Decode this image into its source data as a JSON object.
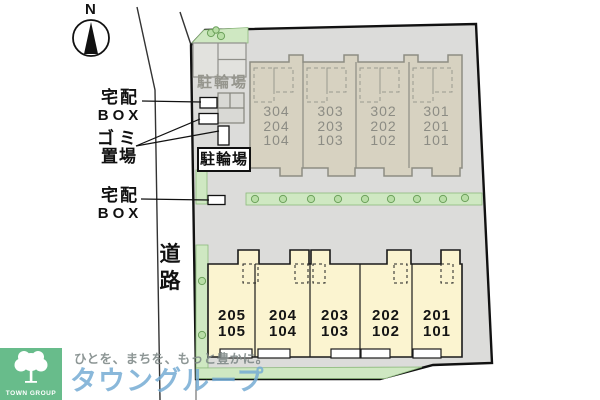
{
  "plan": {
    "compass": "N",
    "road_label": [
      "道",
      "路"
    ],
    "labels": {
      "delivery_box_top": [
        "宅配",
        "BOX"
      ],
      "garbage_area": [
        "ゴミ",
        "置場"
      ],
      "delivery_box_bottom": [
        "宅配",
        "BOX"
      ],
      "bicycle_parking_area": "駐輪場",
      "bicycle_parking_sign": "駐輪場"
    },
    "upper_building_units": [
      {
        "floors": [
          "304",
          "204",
          "104"
        ]
      },
      {
        "floors": [
          "303",
          "203",
          "103"
        ]
      },
      {
        "floors": [
          "302",
          "202",
          "102"
        ]
      },
      {
        "floors": [
          "301",
          "201",
          "101"
        ]
      }
    ],
    "lower_building_units": [
      {
        "floors": [
          "205",
          "105"
        ]
      },
      {
        "floors": [
          "204",
          "104"
        ]
      },
      {
        "floors": [
          "203",
          "103"
        ]
      },
      {
        "floors": [
          "202",
          "102"
        ]
      },
      {
        "floors": [
          "201",
          "101"
        ]
      }
    ]
  },
  "branding": {
    "logo_text": "TOWN GROUP",
    "tagline": "ひとを、まちを、もっと豊かに。",
    "company": "タウングループ"
  },
  "colors": {
    "site_fill": "#dcdcda",
    "upper_building_fill": "#d7d2c1",
    "lower_building_fill": "#fbf4d0",
    "greenery": "#cfe8c2",
    "logo_green": "#68bc8b",
    "watermark_blue": "#76abd4"
  }
}
